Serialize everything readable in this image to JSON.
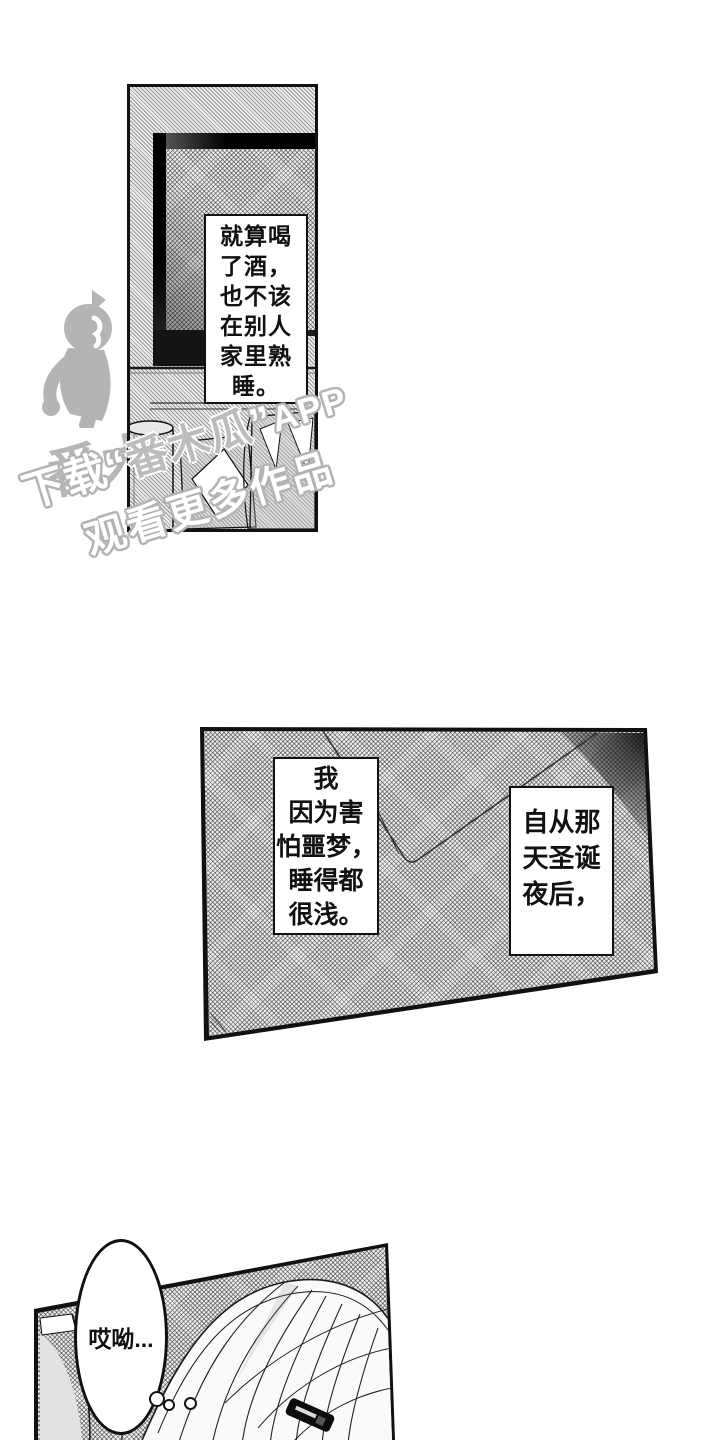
{
  "meta": {
    "kind": "manga-page-screenshot"
  },
  "colors": {
    "ink": "#111111",
    "halftone_gray": "#c9c9c9",
    "watermark_gray": "#b5b5b5",
    "paper_white": "#ffffff"
  },
  "panel1": {
    "narration_lines": [
      "就算喝",
      "了酒，",
      "也不该",
      "在别人",
      "家里熟",
      "睡。"
    ]
  },
  "panel2": {
    "narration_left_lines": [
      "我",
      "因为害",
      "怕噩梦，",
      "睡得都",
      "很浅。"
    ],
    "narration_right_lines": [
      "自从那",
      "天圣诞",
      "夜后，"
    ]
  },
  "panel3": {
    "speech_text": "哎呦..."
  },
  "watermark": {
    "logo_brand": "番木瓜",
    "tagline_download": "下载",
    "tagline_quote_open": "“",
    "tagline_brand": "番木瓜",
    "tagline_quote_close": "”",
    "tagline_app": "APP",
    "tagline_line2": "观看更多作品"
  }
}
